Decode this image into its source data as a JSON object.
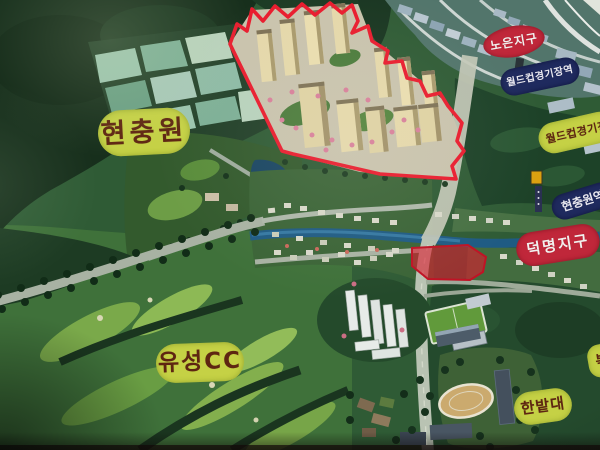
{
  "photo": {
    "title": "Illustrated aerial development-plan map signboard (photo)",
    "labels": {
      "hyeonchungwon": "현충원",
      "yuseong_cc": "유성CC",
      "noeun_district": "노은지구",
      "worldcup_stadium_station": "월드컵경기장역",
      "worldcup_stadium": "월드컵경기장",
      "hyeonchungwon_station": "현충원역",
      "deokmyeong_district": "덕명지구",
      "hanbat_university": "한밭대",
      "right_edge_partial": "복"
    },
    "colors": {
      "label_yellow_bg": "#c5d145",
      "label_yellow_text": "#5e2511",
      "label_red_bg": "#c0273a",
      "label_navy_bg": "#1f2a5e",
      "site_outline_red": "#e01f30",
      "red_zone_fill": "#d12136",
      "river_blue": "#225a80"
    }
  }
}
